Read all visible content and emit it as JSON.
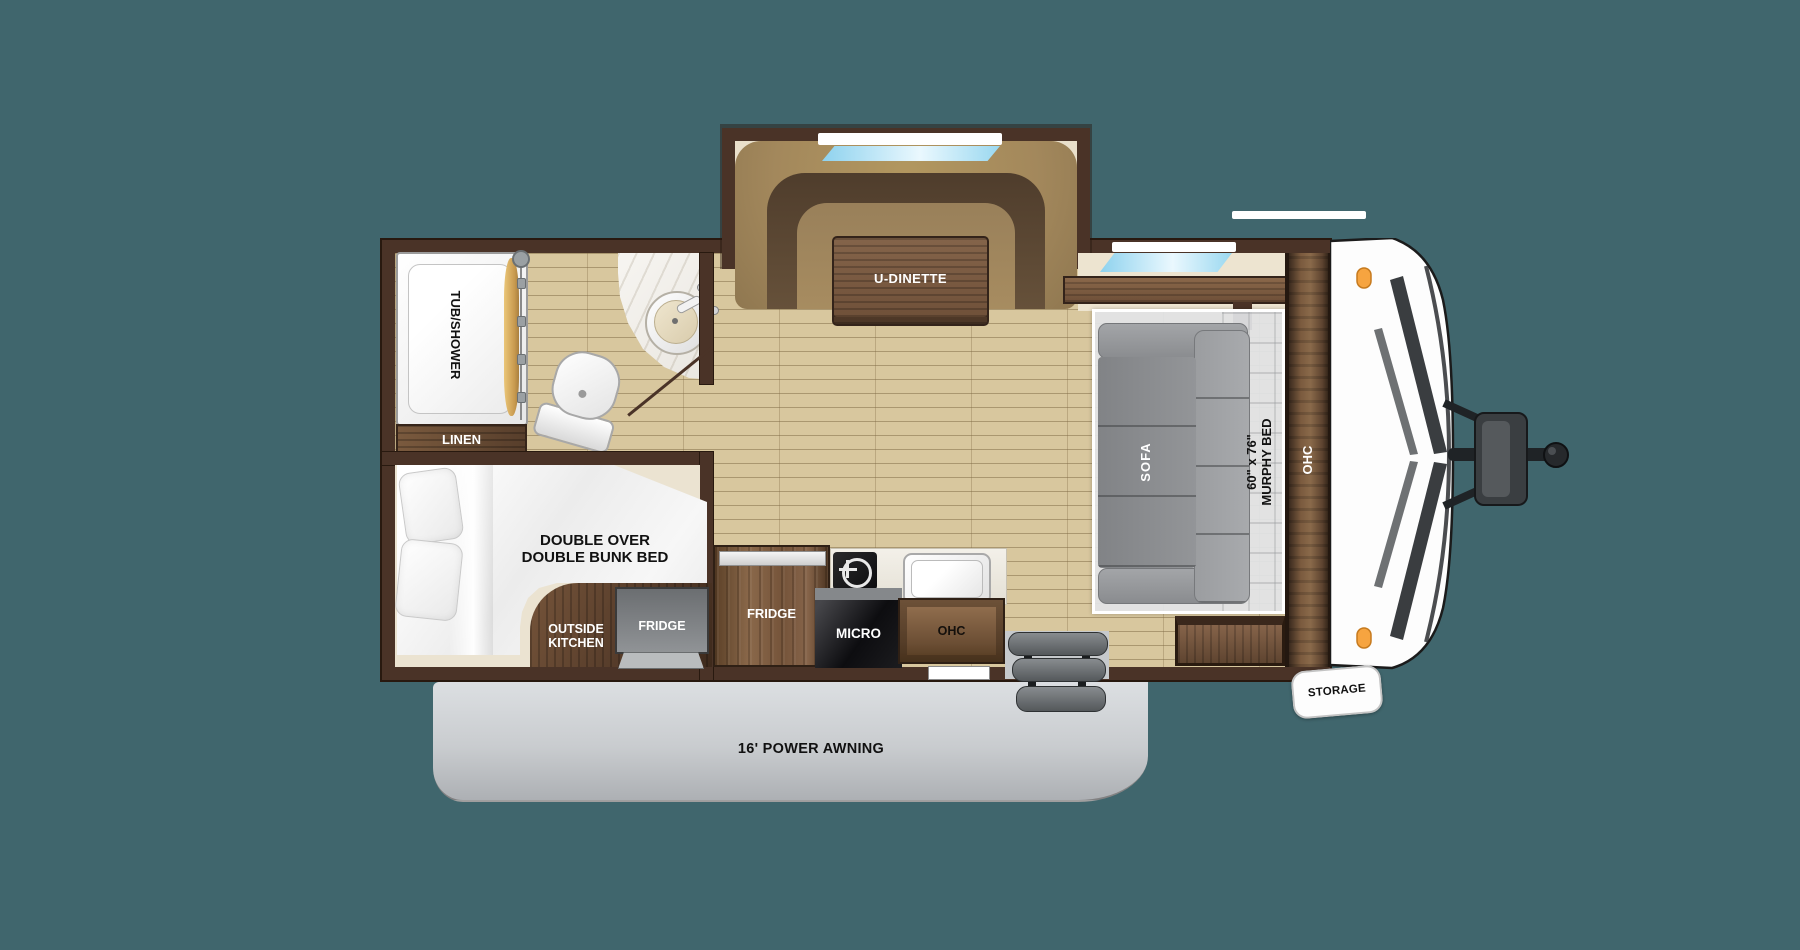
{
  "title": "Travel trailer floor plan",
  "colors": {
    "background": "#40666D",
    "wall": "#4A3327",
    "floor_plank": "#D8C79E",
    "interior_cream": "#EBE3D1",
    "wood_cabinet": "#7A5A3E",
    "bench_tan": "#A3885C",
    "sofa_gray": "#939598",
    "awning_gray": "#C9CCCF",
    "window_blue": "#8ED2EE",
    "clearance_light_orange": "#F6A440"
  },
  "labels": {
    "tub_shower": "TUB/SHOWER",
    "linen": "LINEN",
    "bunk_line1": "DOUBLE OVER",
    "bunk_line2": "DOUBLE BUNK BED",
    "outside_kitchen_line1": "OUTSIDE",
    "outside_kitchen_line2": "KITCHEN",
    "outside_fridge": "FRIDGE",
    "inside_fridge": "FRIDGE",
    "micro": "MICRO",
    "kitchen_ohc": "OHC",
    "u_dinette": "U-DINETTE",
    "sofa": "SOFA",
    "murphy_line1": "60\" x 76\"",
    "murphy_line2": "MURPHY BED",
    "front_ohc": "OHC",
    "storage": "STORAGE",
    "awning": "16' POWER AWNING"
  },
  "features": [
    "Tub/shower with curtain",
    "Linen cabinet",
    "Toilet",
    "Corner vanity sink",
    "Double over double bunk bed",
    "Outside kitchen with fridge",
    "Interior fridge",
    "Cooktop",
    "Microwave",
    "Kitchen sink",
    "Overhead cabinets",
    "U-shaped dinette slide-out with window",
    "Sofa under 60 x 76 murphy bed",
    "Front overhead cabinet",
    "Front pass-through storage",
    "Entry steps",
    "16 foot power awning",
    "A-frame hitch with tongue jack"
  ]
}
